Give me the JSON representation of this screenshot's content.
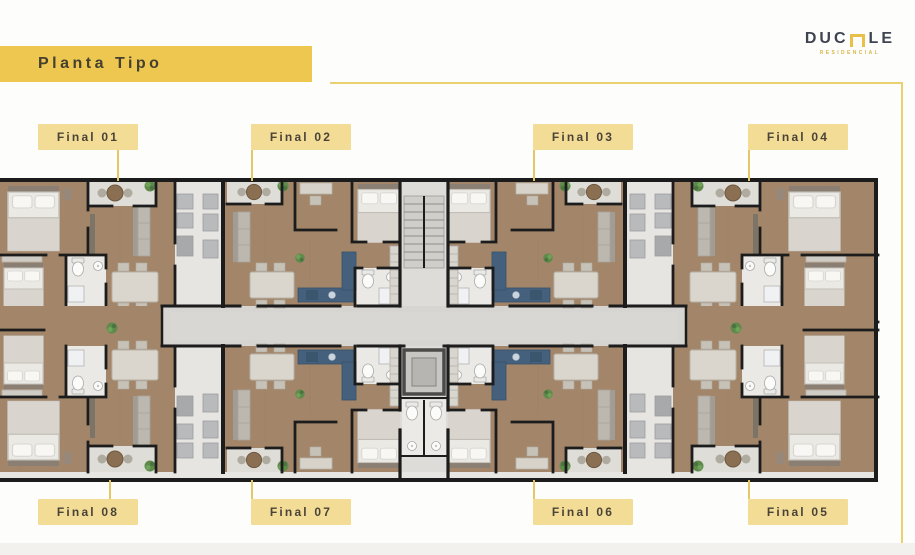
{
  "header": {
    "banner_title": "Planta Tipo"
  },
  "logo": {
    "word_left": "DUC",
    "word_right": "LE",
    "subtitle": "RESIDENCIAL"
  },
  "plan_labels": {
    "top": [
      "Final 01",
      "Final 02",
      "Final 03",
      "Final 04"
    ],
    "bottom": [
      "Final 08",
      "Final 07",
      "Final 06",
      "Final 05"
    ]
  },
  "colors": {
    "banner_yellow": "#edc74f",
    "label_yellow": "#f3dd96",
    "connector_yellow": "#e6c766",
    "logo_text": "#3e4450",
    "logo_accent": "#e8c14d",
    "wall_black": "#1c1c1c",
    "wood_floor": "#a3866a",
    "corridor_gray": "#d7d5d1",
    "balcony_gray": "#dfddd8",
    "kitchen_blue": "#44607c",
    "plant_green": "#5e8b4a"
  }
}
